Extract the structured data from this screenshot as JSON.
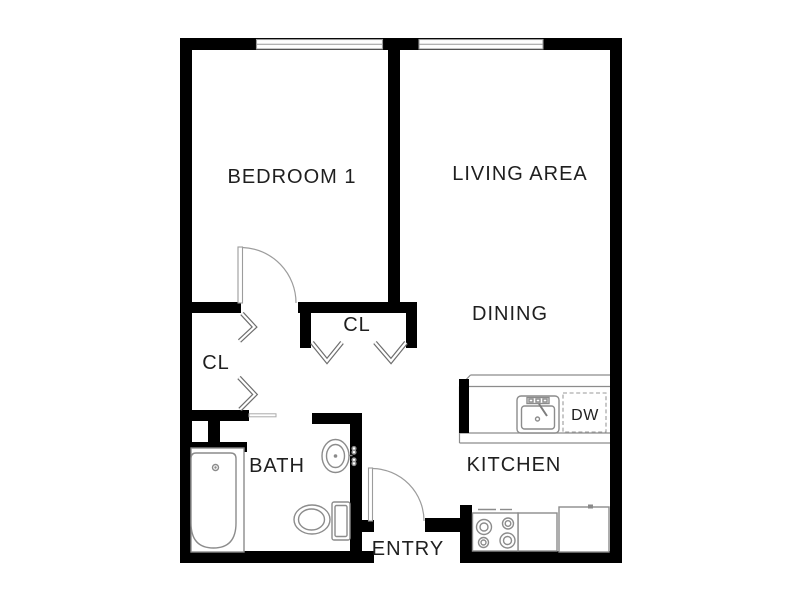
{
  "plan": {
    "type": "apartment-floor-plan",
    "labels": {
      "bedroom": "BEDROOM 1",
      "living": "LIVING AREA",
      "dining": "DINING",
      "kitchen": "KITCHEN",
      "bath": "BATH",
      "entry": "ENTRY",
      "hall_closet": "CL",
      "bedroom_closet": "CL",
      "dishwasher": "DW"
    },
    "colors": {
      "wall": "#000000",
      "fixture_line": "#8c8c8c",
      "window_line": "#9a9a9a",
      "label_text": "#1f1f1f",
      "background": "#ffffff"
    }
  }
}
